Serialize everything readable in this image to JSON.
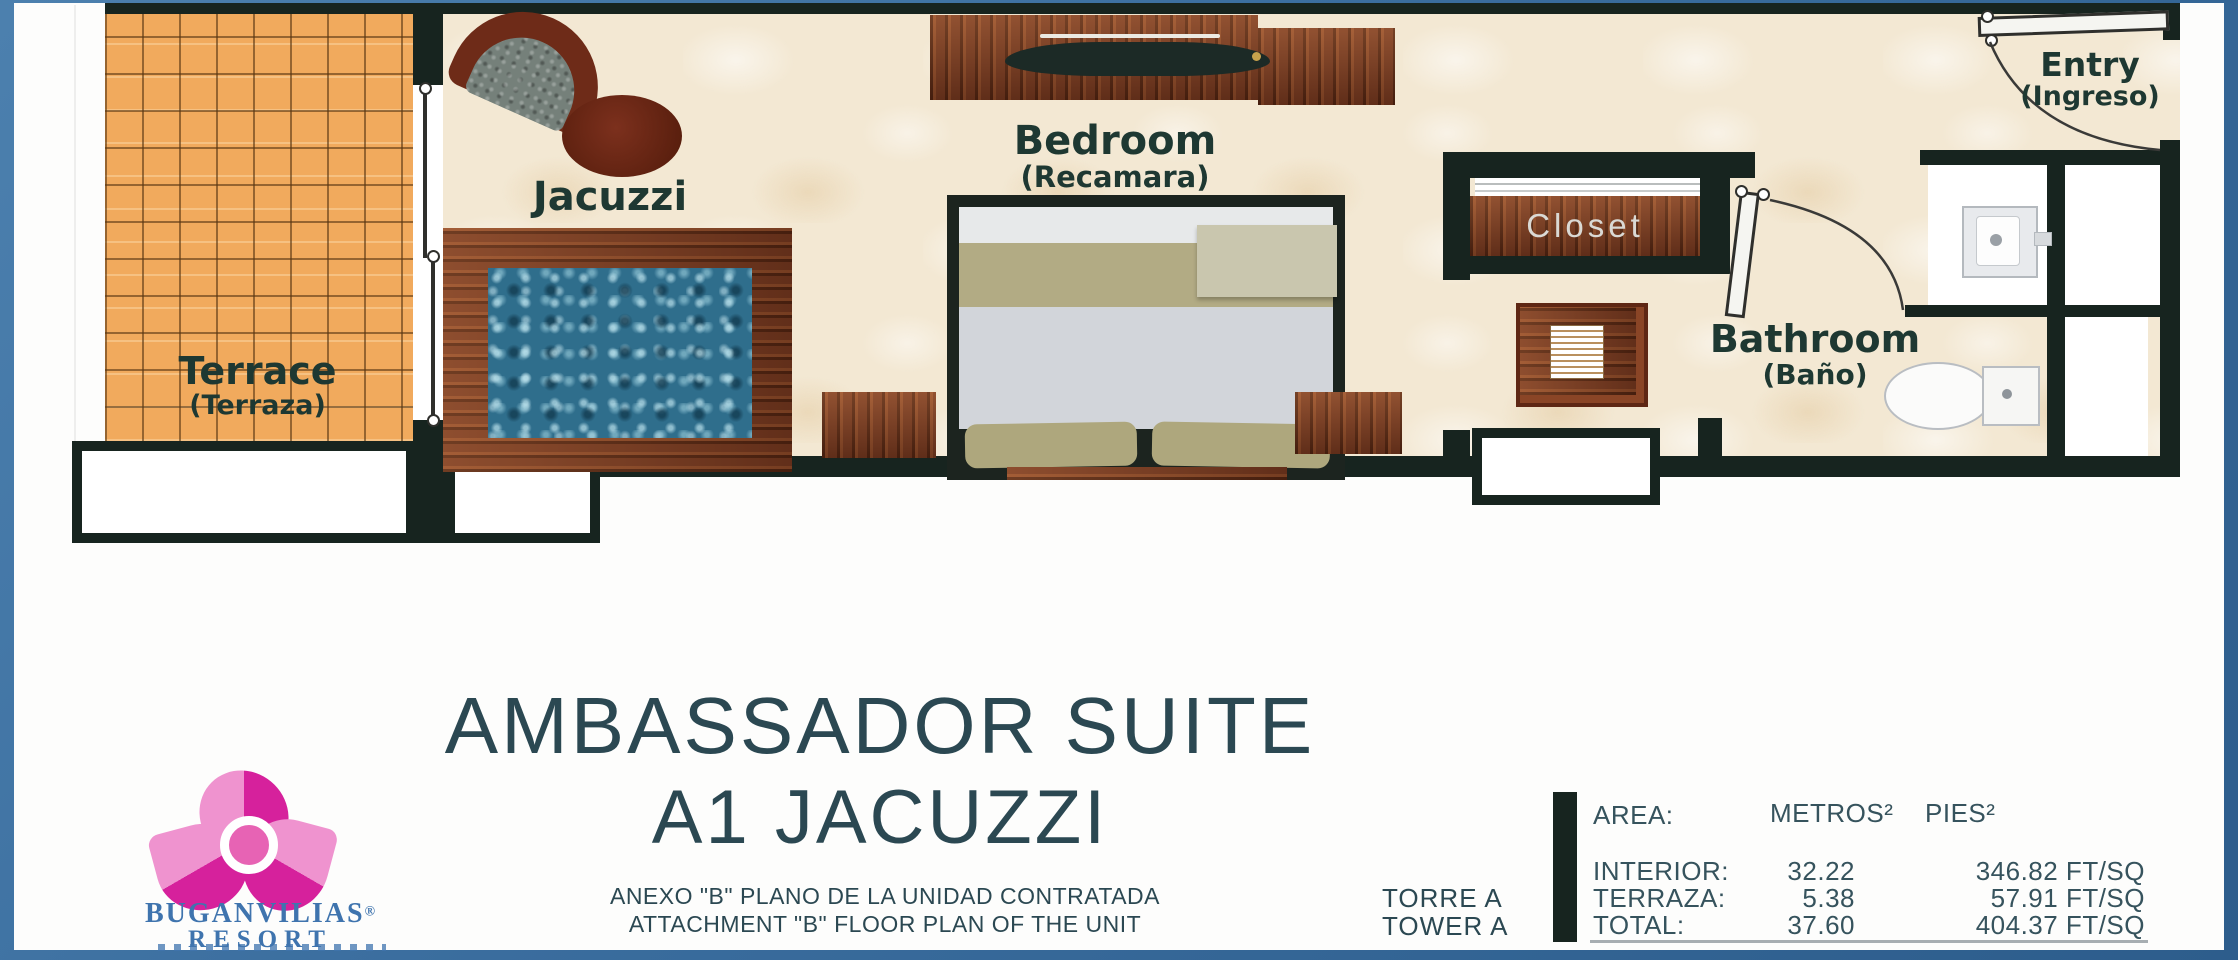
{
  "plan": {
    "labels": {
      "terrace": {
        "en": "Terrace",
        "es": "(Terraza)"
      },
      "jacuzzi": {
        "en": "Jacuzzi"
      },
      "bedroom": {
        "en": "Bedroom",
        "es": "(Recamara)"
      },
      "closet": {
        "en": "Closet"
      },
      "bathroom": {
        "en": "Bathroom",
        "es": "(Baño)"
      },
      "entry": {
        "en": "Entry",
        "es": "(Ingreso)"
      }
    }
  },
  "title_block": {
    "line1": "AMBASSADOR SUITE",
    "line2": "A1 JACUZZI",
    "note_es": "ANEXO \"B\" PLANO DE LA UNIDAD CONTRATADA",
    "note_en": "ATTACHMENT \"B\" FLOOR PLAN OF THE UNIT",
    "tower_es": "TORRE A",
    "tower_en": "TOWER A"
  },
  "logo": {
    "name": "BUGANVILIAS",
    "reg": "®",
    "subname": "RESORT"
  },
  "area_table": {
    "area_label": "AREA:",
    "col_metros": "METROS²",
    "col_pies": "PIES²",
    "rows": [
      {
        "label": "INTERIOR:",
        "metros": "32.22",
        "pies": "346.82 FT/SQ"
      },
      {
        "label": "TERRAZA:",
        "metros": "5.38",
        "pies": "57.91 FT/SQ"
      },
      {
        "label": "TOTAL:",
        "metros": "37.60",
        "pies": "404.37 FT/SQ"
      }
    ]
  },
  "colors": {
    "wall": "#17241f",
    "room_label": "#1e3832",
    "title_text": "#2b4852",
    "terrace_tile": "#f1aa5d",
    "wood": "#7a3a20",
    "jacuzzi_water": "#2f6e8c",
    "logo_pink_dark": "#d6219c",
    "logo_pink_light": "#ef93cf",
    "logo_blue": "#3f74ae",
    "frame_blue": "#3a6d9e",
    "frame_navy": "#1c4876"
  }
}
